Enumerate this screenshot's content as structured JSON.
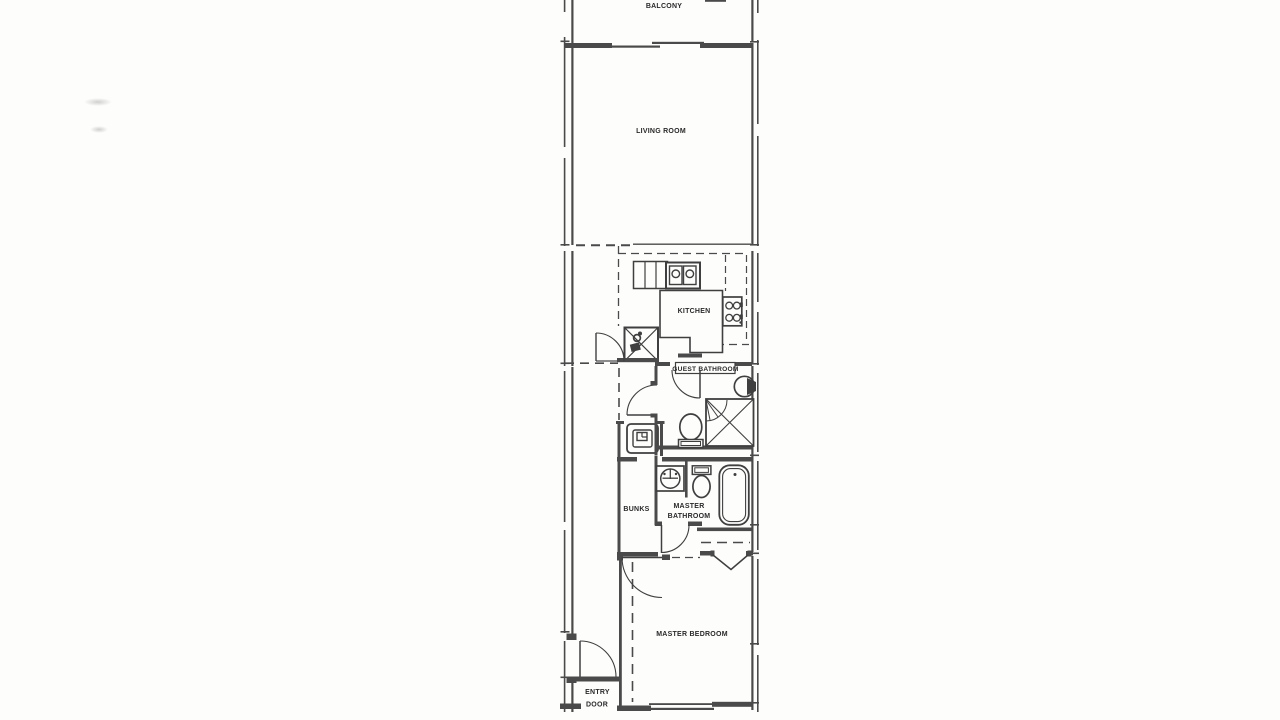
{
  "document": {
    "type": "apartment floor plan (scanned drawing)"
  },
  "colors": {
    "wall": "#4a4a4a",
    "fixture": "#3f3f3f",
    "text": "#2a2a2a",
    "background": "#fdfdfc"
  },
  "rooms": {
    "balcony": {
      "label": "BALCONY"
    },
    "living_room": {
      "label": "LIVING ROOM"
    },
    "kitchen": {
      "label": "KITCHEN"
    },
    "guest_bathroom": {
      "label": "GUEST BATHROOM"
    },
    "bunks": {
      "label": "BUNKS"
    },
    "master_bathroom": {
      "label_line1": "MASTER",
      "label_line2": "BATHROOM"
    },
    "master_bedroom": {
      "label": "MASTER BEDROOM"
    },
    "entry": {
      "label_line1": "ENTRY",
      "label_line2": "DOOR"
    }
  },
  "fixtures": [
    "sliding-glass-door",
    "kitchen-double-sink",
    "range-cooktop",
    "water-heater-closet",
    "stacked-washer",
    "guest-sink",
    "guest-toilet",
    "corner-shower",
    "master-vanity-sink",
    "master-toilet",
    "bathtub",
    "bifold-closet-door",
    "entry-swing-door"
  ]
}
